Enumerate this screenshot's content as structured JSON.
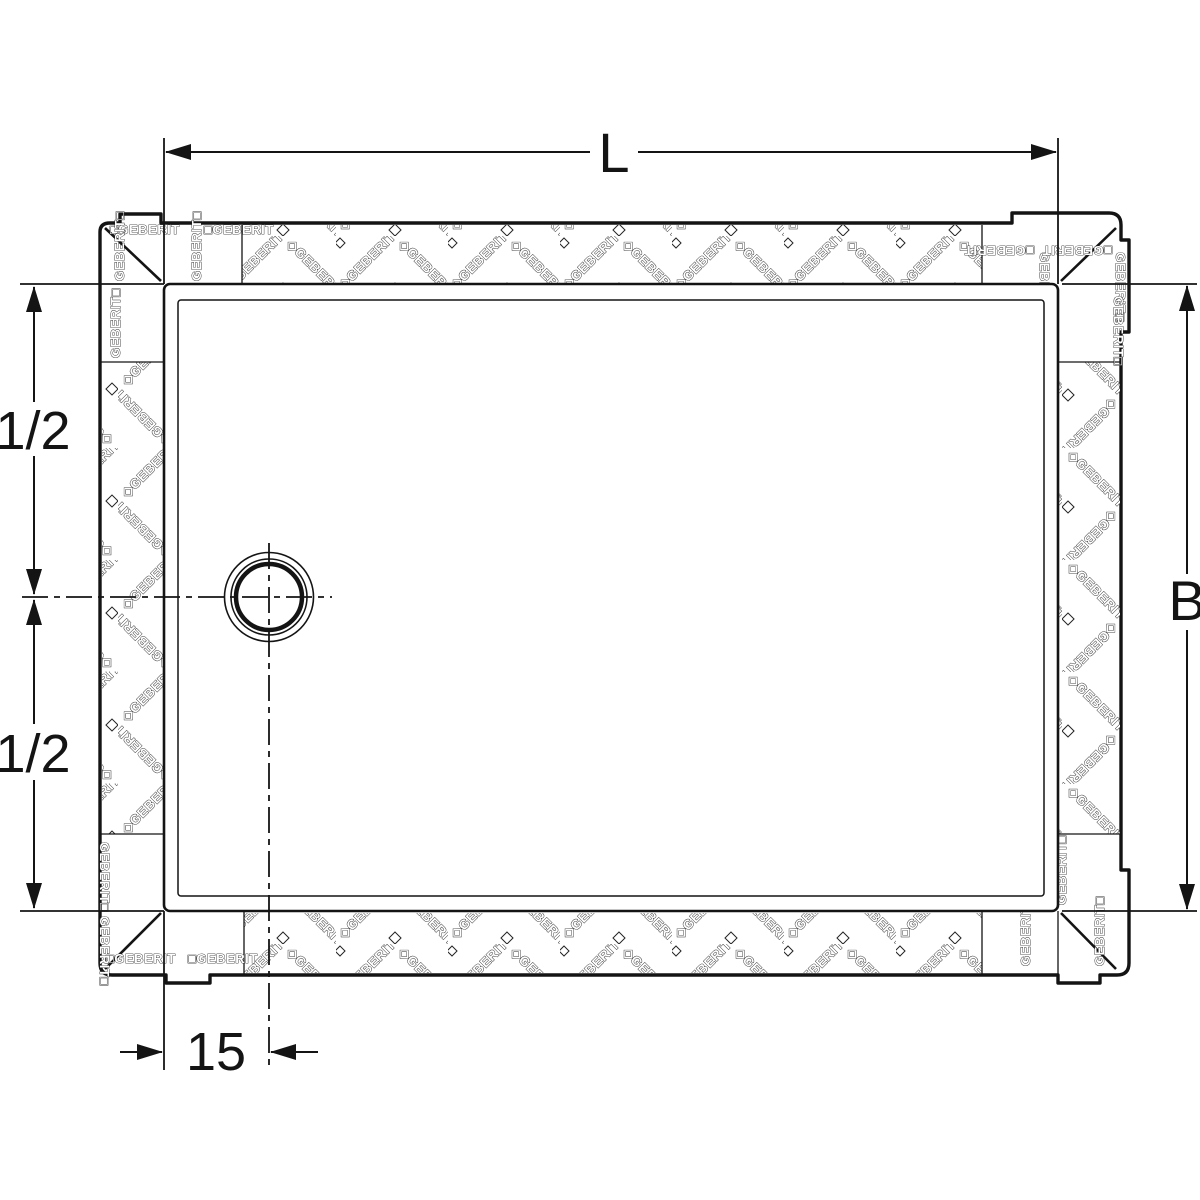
{
  "diagram": {
    "brand": "GEBERIT",
    "type_note": "shower-tray plan view with sealing membrane border",
    "labels": {
      "length": "L",
      "width": "B",
      "half_upper": "1/2",
      "half_lower": "1/2",
      "drain_offset": "15"
    },
    "membrane": {
      "tape_text": "◇GEBERIT",
      "tag_h": "□GEBERIT",
      "tag_v": "GEBERIT□"
    },
    "colors": {
      "line": "#141414",
      "background": "#ffffff"
    }
  }
}
